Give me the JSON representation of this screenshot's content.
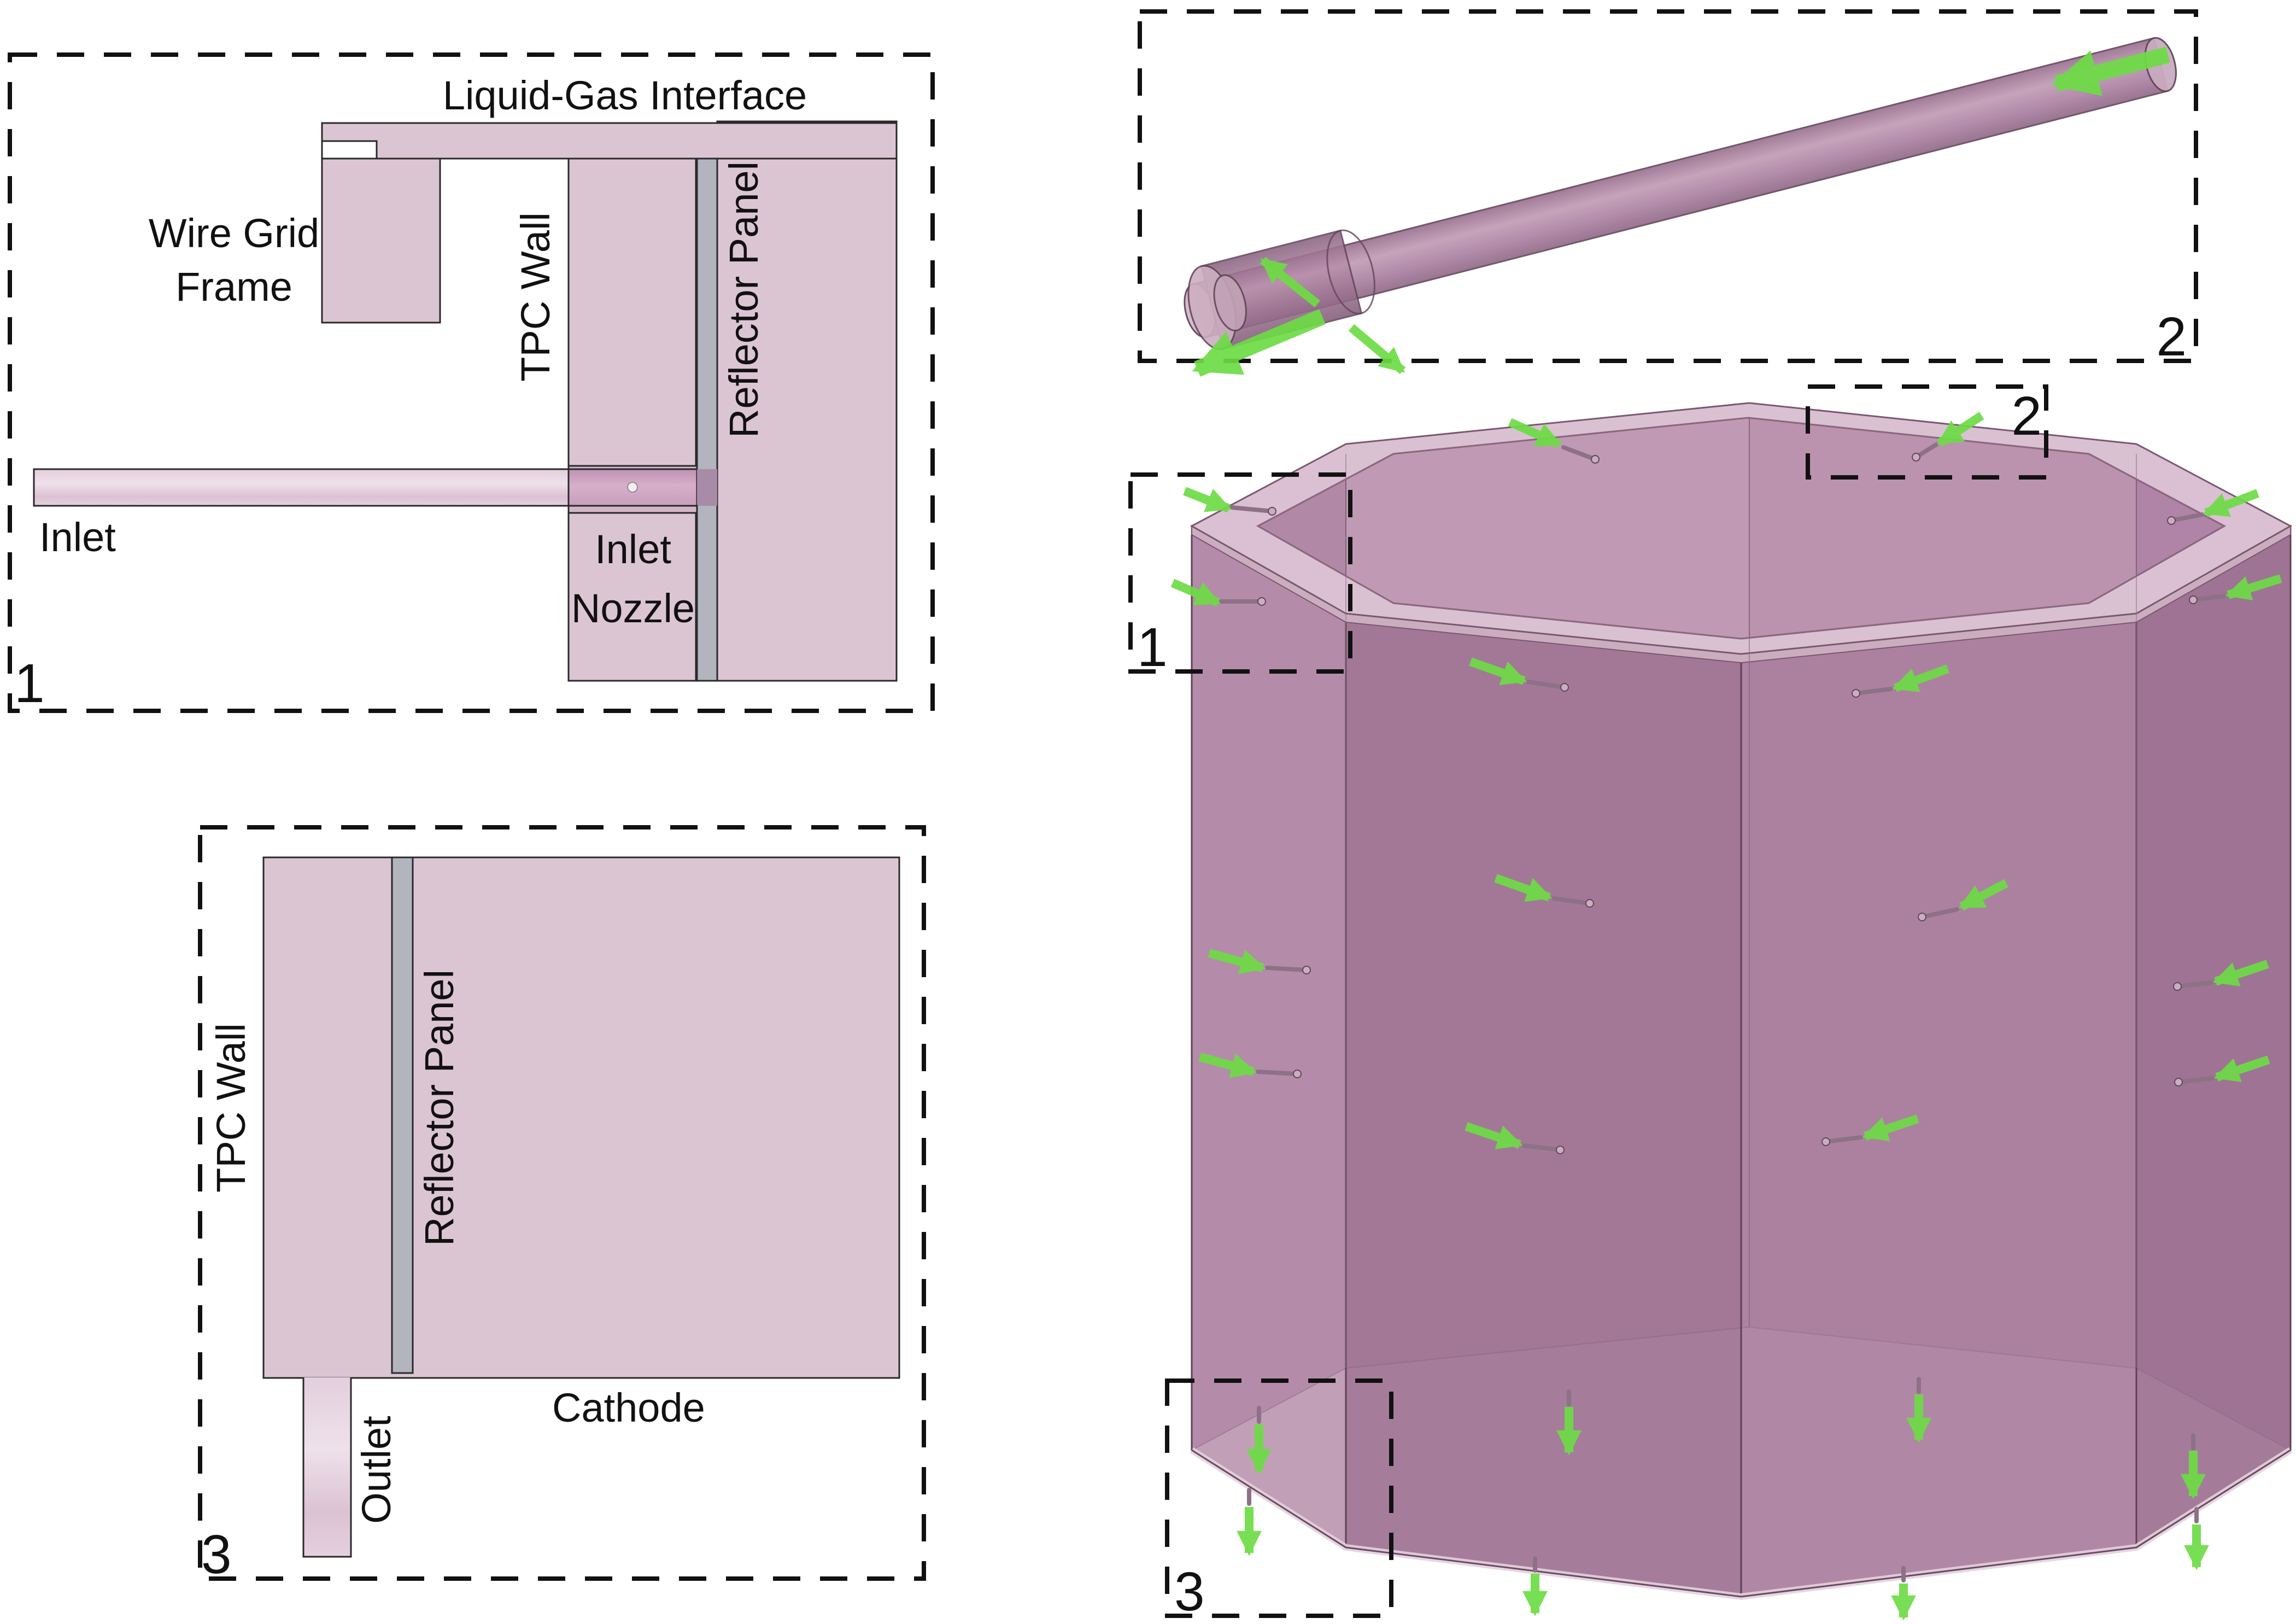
{
  "panel1": {
    "callout": "1",
    "liquid_gas_interface": "Liquid-Gas Interface",
    "wire_grid_frame_line1": "Wire Grid",
    "wire_grid_frame_line2": "Frame",
    "tpc_wall": "TPC Wall",
    "reflector_panel": "Reflector Panel",
    "inlet": "Inlet",
    "inlet_nozzle_line1": "Inlet",
    "inlet_nozzle_line2": "Nozzle"
  },
  "panel2": {
    "callout": "2"
  },
  "panel3": {
    "callout": "3",
    "tpc_wall": "TPC Wall",
    "reflector_panel": "Reflector Panel",
    "outlet": "Outlet",
    "cathode": "Cathode"
  },
  "main_view": {
    "callout_1": "1",
    "callout_2": "2",
    "callout_3": "3"
  },
  "colors": {
    "ink": "#111111",
    "line": "#2a2a2a",
    "edge": "#63465b",
    "pink": "#dcc5d3",
    "pink_light": "#ead9e5",
    "pink_mid": "#cfa9c2",
    "gray": "#b2b5be",
    "green": "#6ddc45",
    "mauve_rim": "#dcc3d4",
    "mauve_rim_dark": "#cbadc0",
    "mauve_back": "#bb93ae",
    "mauve_back_light": "#c09ab4",
    "mauve_wall": "#a87c9d",
    "mauve_wall_dark": "#9c7091",
    "floor": "#ccb2c4",
    "pin": "#8d7186",
    "pin_light": "#c9aec0"
  }
}
